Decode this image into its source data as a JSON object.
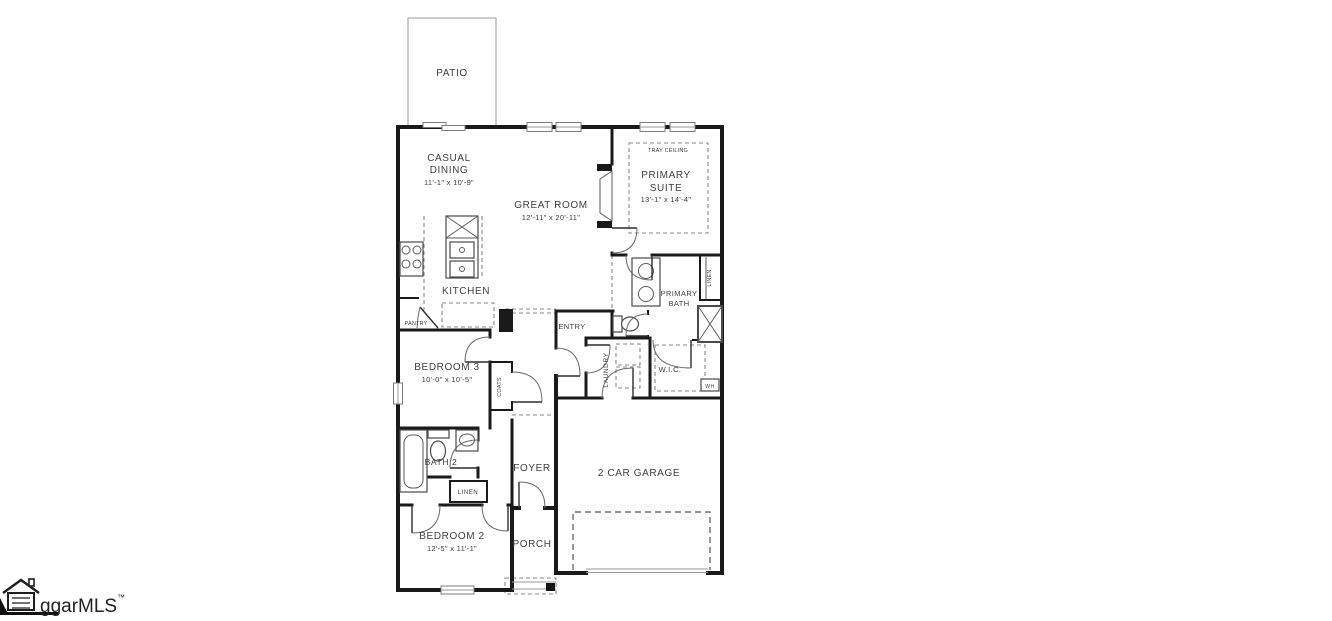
{
  "rooms": {
    "patio": {
      "label": "PATIO"
    },
    "casual_dining": {
      "line1": "CASUAL",
      "line2": "DINING",
      "dims": "11'-1\" x 10'-9\""
    },
    "great_room": {
      "label": "GREAT ROOM",
      "dims": "12'-11\" x 20'-11\""
    },
    "primary_suite": {
      "line1": "PRIMARY",
      "line2": "SUITE",
      "dims": "13'-1\" x 14'-4\"",
      "ceiling_note": "TRAY CEILING"
    },
    "kitchen": {
      "label": "KITCHEN"
    },
    "pantry": {
      "label": "PANTRY"
    },
    "entry": {
      "label": "ENTRY"
    },
    "primary_bath": {
      "line1": "PRIMARY",
      "line2": "BATH"
    },
    "primary_bath_linen": {
      "label": "LINEN"
    },
    "bedroom3": {
      "label": "BEDROOM 3",
      "dims": "10'-0\" x 10'-5\""
    },
    "coats": {
      "label": "COATS"
    },
    "laundry": {
      "label": "LAUNDRY"
    },
    "wic": {
      "label": "W.I.C."
    },
    "water_heater": {
      "label": "WH"
    },
    "bath2": {
      "label": "BATH 2"
    },
    "hall_linen": {
      "label": "LINEN"
    },
    "foyer": {
      "label": "FOYER"
    },
    "garage": {
      "label": "2 CAR GARAGE"
    },
    "bedroom2": {
      "label": "BEDROOM 2",
      "dims": "12'-5\" x 11'-1\""
    },
    "porch": {
      "label": "PORCH"
    }
  },
  "watermark": {
    "brand": "ggarMLS",
    "tm": "™"
  },
  "colors": {
    "wall": "#1a1a1a",
    "line_gray": "#8a8a8a",
    "text": "#3f3f3f"
  }
}
